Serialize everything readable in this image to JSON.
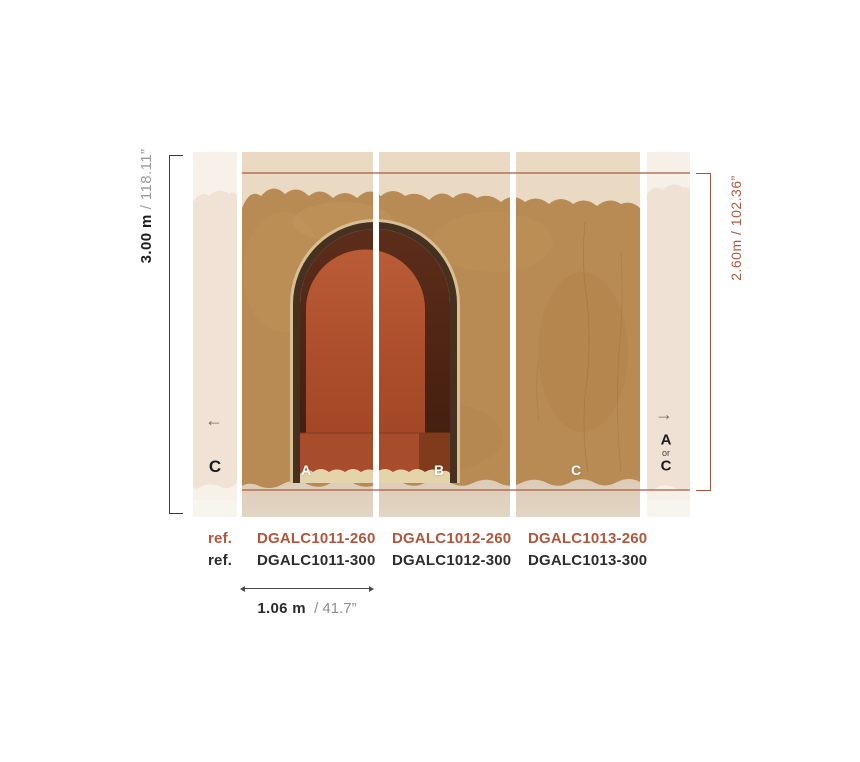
{
  "dimensions": {
    "full_height": {
      "metric": "3.00 m",
      "imperial": "/ 118.11”"
    },
    "design_height": {
      "label": "2.60m / 102.36”"
    },
    "panel_width": {
      "metric": "1.06 m",
      "imperial": "/ 41.7”"
    }
  },
  "panels": {
    "left_strip": {
      "letter": "C",
      "arrow": "←"
    },
    "a": {
      "letter": "A"
    },
    "b": {
      "letter": "B"
    },
    "c": {
      "letter": "C"
    },
    "right_strip": {
      "arrow": "→",
      "option_top": "A",
      "option_sep": "or",
      "option_bottom": "C"
    }
  },
  "refs": {
    "rows": [
      {
        "label": "ref.",
        "codes": [
          "DGALC1011-260",
          "DGALC1012-260",
          "DGALC1013-260"
        ]
      },
      {
        "label": "ref.",
        "codes": [
          "DGALC1011-300",
          "DGALC1012-300",
          "DGALC1013-300"
        ]
      }
    ]
  },
  "colors": {
    "accent_rust": "#a2573d",
    "ref_highlight": "#b2563c",
    "wall_tan": "#b98b54",
    "arch_terracotta": "#ad4f2c",
    "arch_shadow": "#4a2212",
    "cream_top": "#ebdac3",
    "strip_cream": "#f0e2d5"
  }
}
